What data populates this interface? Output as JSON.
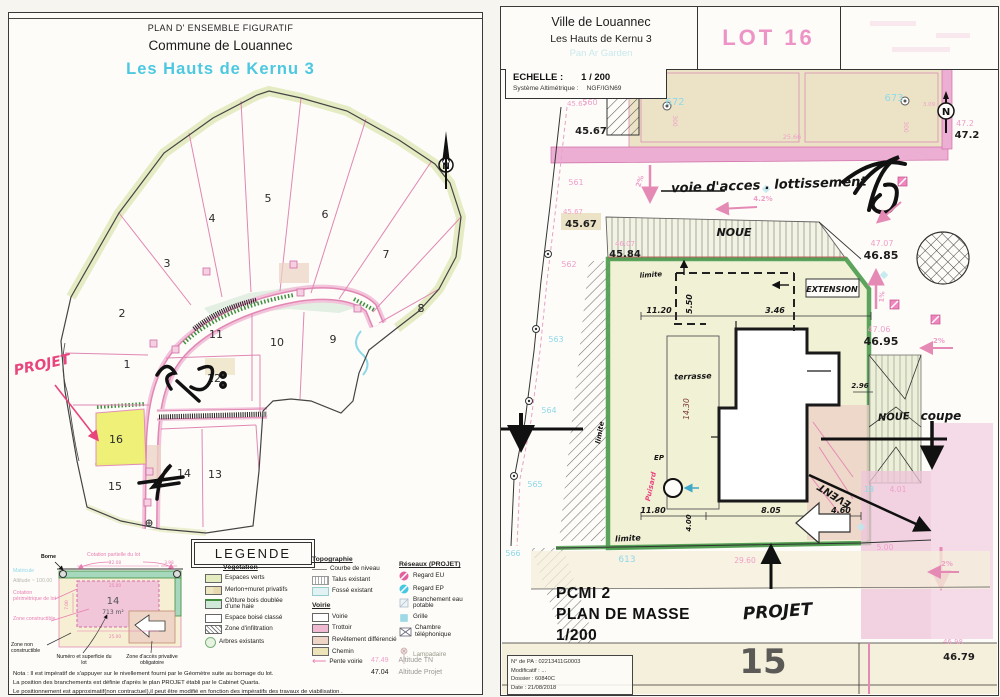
{
  "left_sheet": {
    "header": {
      "doc_type": "PLAN D' ENSEMBLE FIGURATIF",
      "commune": "Commune de Louannec",
      "title": "Les Hauts de Kernu 3"
    },
    "plan": {
      "north": "N",
      "projet_note": "PROJET",
      "lots": [
        "1",
        "2",
        "3",
        "4",
        "5",
        "6",
        "7",
        "8",
        "9",
        "10",
        "11",
        "12",
        "13",
        "14",
        "15",
        "16"
      ]
    },
    "legend": {
      "title": "LEGENDE",
      "vegetation": {
        "heading": "Végétation",
        "items": [
          "Espaces verts",
          "Merlon+muret privatifs",
          "Clôture bois doublée d'une haie",
          "Espace boisé classé",
          "Zone d'infiltration",
          "Arbres existants"
        ]
      },
      "topographie": {
        "heading": "Topographie",
        "items": [
          "Courbe de niveau",
          "Talus existant",
          "Fossé existant"
        ]
      },
      "voirie": {
        "heading": "Voirie",
        "items": [
          "Voirie",
          "Trottoir",
          "Revêtement différencié",
          "Chemin",
          "Pente voirie"
        ]
      },
      "reseaux": {
        "heading": "Réseaux (PROJET)",
        "items": [
          "Regard EU",
          "Regard EP",
          "Branchement eau potable",
          "Grille",
          "Chambre téléphonique",
          "Lampadaire"
        ]
      },
      "alt_tn_value": "47.49",
      "alt_tn_label": "Altitude TN",
      "alt_projet_value": "47.04",
      "alt_projet_label": "Altitude Projet",
      "example": {
        "borne": "Borne",
        "matricule": "Matricule",
        "altitude_label": "Altitude",
        "altitude_value": "~ 100.00",
        "cot_partielle": "Cotation partielle du lot",
        "cot_perimetrique": "Cotation périmétrique de lot",
        "zone_constructible": "Zone constructible",
        "zone_non_constructible": "Zone non constructible",
        "numero_superficie": "Numéro et superficie du lot",
        "zone_acces": "Zone d'accès privative obligatoire",
        "lot_number": "14",
        "lot_area": "713 m²",
        "dim_top": "22.08",
        "dim_top2": "3.98",
        "dim_mid": "25.00",
        "dim_left": "7.00",
        "dim_bottom": "25.00"
      },
      "nota": [
        "Nota : Il est impératif de s'appuyer sur le nivellement fourni par le Géomètre suite au bornage du lot.",
        "La position des branchements est définie d'après le plan PROJET établi par le Cabinet Quarta.",
        "Le positionnement est approximatif(non contractuel),il peut être modifié en fonction des impératifs des travaux de viabilisation ."
      ]
    }
  },
  "right_sheet": {
    "header": {
      "city": "Ville de Louannec",
      "subdivision": "Les Hauts de Kernu 3",
      "watermark": "Pan Ar Garden",
      "lot_stamp": "LOT 16"
    },
    "scale": {
      "echelle_label": "ECHELLE :",
      "echelle_value": "1 / 200",
      "alt_label": "Système Altimétrique :",
      "alt_value": "NGF/IGN69"
    },
    "caption": {
      "line1": "PCMI 2",
      "line2": "PLAN DE MASSE",
      "line3": "1/200"
    },
    "info_box": {
      "pa": "N° de PA : 02213411G0003",
      "modificatif": "Modificatif : ...",
      "dossier": "Dossier : 60840C",
      "date": "Date : 21/08/2018"
    },
    "plan": {
      "north": "N",
      "hand": {
        "voie": "voie d'acces . lottissement",
        "noue_top": "NOUE",
        "noue_right": "NOUE",
        "coupe": "coupe",
        "extension": "EXTENSION",
        "terrasse": "terrasse",
        "event": "EVENT",
        "puisard": "Puisard",
        "puisard_ep": "EP",
        "limite_top": "limite",
        "limite_left": "limite",
        "limite_bottom": "limite",
        "projet": "PROJET"
      },
      "alt": {
        "a45_67_top": "45.67",
        "a45_67_mid": "45.67",
        "a45_84": "45.84",
        "a46_85": "46.85",
        "a46_95": "46.95",
        "a47_2": "47.2",
        "a46_79": "46.79"
      },
      "alt_tn": {
        "t45_67_top": "45.67",
        "t45_67_mid": "45.67",
        "t46_07": "46.07",
        "t47_07": "47.07",
        "t47_06": "47.06",
        "t47_2": "47.2",
        "t46_98": "46.98"
      },
      "dim": {
        "d11_20": "11.20",
        "d5_50": "5.50",
        "d3_46": "3.46",
        "d14_30": "14.30",
        "d2_96": "2.96",
        "d11_80": "11.80",
        "d4_00": "4.00",
        "d8_05": "8.05",
        "d4_60": "4.60",
        "d29_60": "29.60",
        "d5_00": "5.00",
        "d4_01": "4.01",
        "d25_66": "25.66",
        "d3_09": "3.09",
        "d300a": "300",
        "d300b": "300"
      },
      "slope": {
        "s2a": "2%",
        "s4_2": "4.2%",
        "s1": "1%",
        "s2b": "2%",
        "s2c": "2%"
      },
      "pts": {
        "p560": "560",
        "p561": "561",
        "p562": "562",
        "p563": "563",
        "p564": "564",
        "p565": "565",
        "p566": "566",
        "p613": "613",
        "p672": "672",
        "p673": "673",
        "p18": "18"
      },
      "neighbor_lot": "15"
    }
  }
}
